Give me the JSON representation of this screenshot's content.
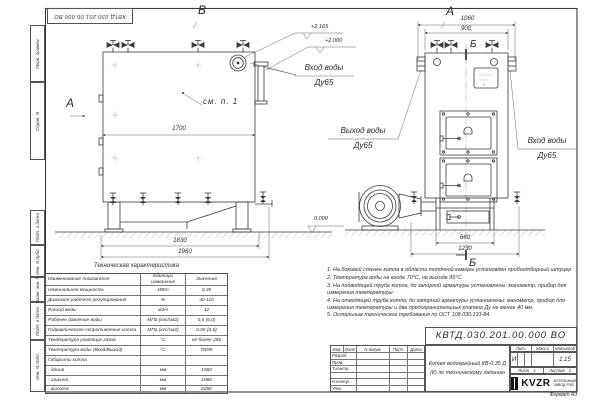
{
  "doc": {
    "number": "КВТД.030.201.00.000 ВО",
    "format": "Формат А3"
  },
  "margins": {
    "top": [
      "Перв. примен.",
      "Справ. N"
    ],
    "bottom": [
      "Подп. и дата",
      "Инв. N дубл.",
      "Взам. инв. N",
      "Подп. и дата",
      "Инв. N подл."
    ]
  },
  "views": {
    "side": {
      "letter_top": "В",
      "letter_left": "А",
      "see_item": "см. п. 1",
      "dim_inner": "1700",
      "dim_skid": "1830",
      "dim_length": "1960",
      "elev_zero": "0.000",
      "elev_top": "+2.165",
      "elev_pipe": "+2.000",
      "inlet_title": "Вход воды",
      "inlet_dn": "Ду65"
    },
    "front": {
      "letter": "А",
      "section_top": "Б",
      "section_bottom": "Б",
      "dim_overall": "1060",
      "dim_body": "900",
      "dim_base": "660",
      "dim_total": "1230",
      "outlet_title": "Выход воды",
      "outlet_dn": "Ду65",
      "inlet_title": "Вход воды",
      "inlet_dn": "Ду65"
    }
  },
  "tech_table": {
    "title": "Техническая характеристика",
    "headers": [
      "Наименование показателя",
      "Единицы измерения",
      "Значение"
    ],
    "rows": [
      [
        "Номинальная мощность",
        "МВт",
        "0,35"
      ],
      [
        "Диапазон рабочего регулирования",
        "%",
        "40-110"
      ],
      [
        "Расход воды",
        "м3/ч",
        "12"
      ],
      [
        "Рабочее давление воды",
        "МПа (кгс/см2)",
        "0,6 (6,0)"
      ],
      [
        "Гидравлическое сопротивление котла",
        "МПа (кгс/см2)",
        "0,06 (0,6)"
      ],
      [
        "Температура уходящих газов",
        "°С",
        "не более 280"
      ],
      [
        "Температура воды (Вход/Выход)",
        "°С",
        "70/95"
      ],
      [
        "Габариты котла",
        "",
        ""
      ],
      [
        "- длина",
        "мм",
        "1960"
      ],
      [
        "- ширина",
        "мм",
        "1060"
      ],
      [
        "- высота",
        "мм",
        "2050"
      ]
    ]
  },
  "notes": [
    "1. На боковой стенке котла в области топочной камеры установлен пробоотборный штуцер",
    "2. Температура воды на входе 70°С, на выходе 95°С.",
    "3. На подводящей трубе котла, до запорной арматуры установлены: манометр, прибор для измерения температуры.",
    "4. На отводящей трубе котла, до запорной арматуры установлены: манометр, прибор для измерения температуры и два предохранительных клапана Ду не менее 40 мм.",
    "5. Остальные технические требования по ОСТ 108.030.133-84."
  ],
  "title_block": {
    "doc_number": "КВТД.030.201.00.000 ВО",
    "product_title": "Котел водогрейный КВ-0,35 Д (К) по техническому заданию",
    "header_cols": [
      "Изм.",
      "Лист",
      "N докум.",
      "Подп.",
      "Дата"
    ],
    "row_labels": [
      "Разраб.",
      "Пров.",
      "Т.контр.",
      "",
      "Н.контр.",
      "Утв."
    ],
    "lit_label": "Лит.",
    "mass_label": "Масса",
    "scale_label": "Масштаб",
    "lit_value": "И",
    "scale_value": "1:15",
    "sheet_label": "Лист",
    "sheet_value": "1",
    "sheets_label": "Листов",
    "sheets_value": "2",
    "logo_text": "KVZR",
    "company_line1": "КОТЕЛЬНЫЙ",
    "company_line2": "ЗАВОД РЭП"
  }
}
